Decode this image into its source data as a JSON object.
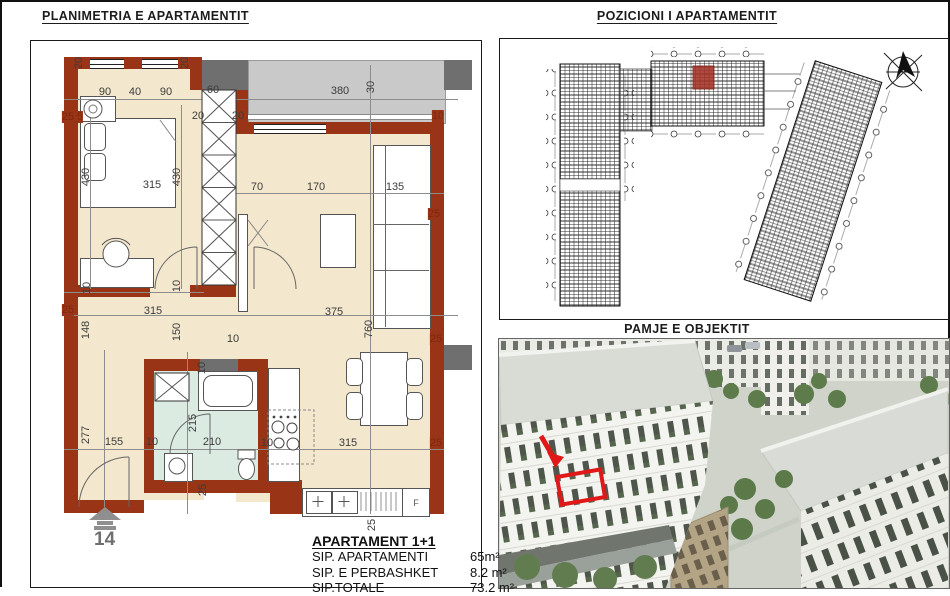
{
  "page": {
    "plan_title": "PLANIMETRIA E APARTAMENTIT",
    "position_title": "POZICIONI I APARTAMENTIT",
    "view_title": "PAMJE E OBJEKTIT"
  },
  "plan": {
    "unit_number": "14",
    "fridge_label": "F",
    "dims": [
      {
        "t": "20",
        "x": 77,
        "y": 61,
        "r": 1
      },
      {
        "t": "20",
        "x": 183,
        "y": 61,
        "r": 1
      },
      {
        "t": "90",
        "x": 103,
        "y": 90
      },
      {
        "t": "40",
        "x": 133,
        "y": 90
      },
      {
        "t": "90",
        "x": 164,
        "y": 90
      },
      {
        "t": "60",
        "x": 211,
        "y": 88
      },
      {
        "t": "380",
        "x": 338,
        "y": 89
      },
      {
        "t": "30",
        "x": 369,
        "y": 85,
        "r": 1
      },
      {
        "t": "25",
        "x": 66,
        "y": 115,
        "w": 1
      },
      {
        "t": "5",
        "x": 78,
        "y": 115,
        "w": 1
      },
      {
        "t": "20",
        "x": 196,
        "y": 114
      },
      {
        "t": "20",
        "x": 236,
        "y": 114
      },
      {
        "t": "10",
        "x": 436,
        "y": 114,
        "w": 1
      },
      {
        "t": "315",
        "x": 150,
        "y": 183
      },
      {
        "t": "430",
        "x": 84,
        "y": 175,
        "r": 1
      },
      {
        "t": "430",
        "x": 175,
        "y": 175,
        "r": 1
      },
      {
        "t": "70",
        "x": 255,
        "y": 185
      },
      {
        "t": "170",
        "x": 314,
        "y": 185
      },
      {
        "t": "135",
        "x": 393,
        "y": 185
      },
      {
        "t": "25",
        "x": 432,
        "y": 212,
        "w": 1
      },
      {
        "t": "10",
        "x": 85,
        "y": 286,
        "r": 1
      },
      {
        "t": "10",
        "x": 175,
        "y": 284,
        "r": 1
      },
      {
        "t": "25",
        "x": 66,
        "y": 308,
        "w": 1
      },
      {
        "t": "315",
        "x": 151,
        "y": 309
      },
      {
        "t": "375",
        "x": 332,
        "y": 310
      },
      {
        "t": "148",
        "x": 84,
        "y": 328,
        "r": 1
      },
      {
        "t": "150",
        "x": 175,
        "y": 330,
        "r": 1
      },
      {
        "t": "760",
        "x": 367,
        "y": 327,
        "r": 1
      },
      {
        "t": "25",
        "x": 434,
        "y": 337,
        "w": 1
      },
      {
        "t": "10",
        "x": 231,
        "y": 337
      },
      {
        "t": "10",
        "x": 200,
        "y": 366,
        "r": 1
      },
      {
        "t": "277",
        "x": 84,
        "y": 433,
        "r": 1
      },
      {
        "t": "155",
        "x": 112,
        "y": 440
      },
      {
        "t": "10",
        "x": 150,
        "y": 440
      },
      {
        "t": "210",
        "x": 210,
        "y": 440
      },
      {
        "t": "215",
        "x": 191,
        "y": 421,
        "r": 1
      },
      {
        "t": "10",
        "x": 265,
        "y": 441
      },
      {
        "t": "315",
        "x": 346,
        "y": 441
      },
      {
        "t": "25",
        "x": 434,
        "y": 441,
        "w": 1
      },
      {
        "t": "25",
        "x": 201,
        "y": 488,
        "r": 1
      },
      {
        "t": "25",
        "x": 370,
        "y": 523,
        "r": 1
      }
    ]
  },
  "info": {
    "title": "APARTAMENT 1+1",
    "rows": [
      {
        "label": "SIP. APARTAMENTI",
        "value": "65m²"
      },
      {
        "label": "SIP. E PERBASHKET",
        "value": "8.2 m²"
      },
      {
        "label": "SIP.TOTALE",
        "value": "73.2 m²"
      }
    ]
  },
  "colors": {
    "wall": "#9a3417",
    "floor": "#f3e7cd",
    "bath": "#dcebe2",
    "balcony": "#c9c9c9",
    "dark": "#6f6f6f",
    "highlight": "#e01818",
    "dim": "#3c3c3c",
    "dimwall": "#7c2810"
  }
}
